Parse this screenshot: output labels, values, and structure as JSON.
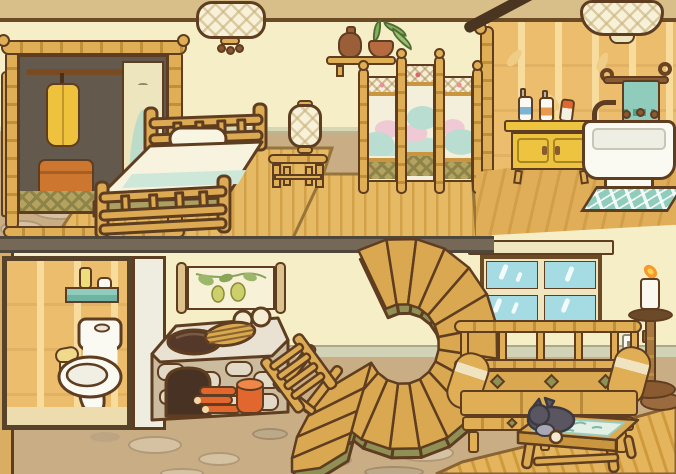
{
  "scene": {
    "title": "Two-story bamboo house interior",
    "style": "hand-drawn cozy home decoration game, cutaway view",
    "visible_text": "none"
  },
  "palette": {
    "outline": "#5f3d20",
    "wall_cream": "#f5eec6",
    "ceiling_tan": "#d8be88",
    "bamboo": "#dfae55",
    "bamboo_shade": "#c08f3a",
    "bathroom_wall": "#ecbd6d",
    "floor_tan": "#c9ae85",
    "stone": "#d5c2a2",
    "mat_gold": "#e6ba64",
    "teal": "#8fccbc",
    "glass_blue": "#a5dce4",
    "mint": "#cde8d9",
    "olive": "#8f9055",
    "step_gold": "#d9a850",
    "orange": "#e2672f",
    "cabinet_yellow": "#eec33f",
    "divider_grey": "#756857",
    "baseboard_sage": "#d2d2b6",
    "white": "#fbfaf2"
  },
  "upper_floor": {
    "bedroom": {
      "items": [
        {
          "name": "hanging lattice lantern"
        },
        {
          "name": "bamboo wardrobe with open door, yellow robe and orange suitcase"
        },
        {
          "name": "bamboo double bed with mint bedding and pillow"
        },
        {
          "name": "bedside bamboo stool with lattice lamp"
        },
        {
          "name": "wall shelf with brown vase and potted plant"
        },
        {
          "name": "three-panel bamboo folding screen with landscape painting"
        },
        {
          "name": "round window"
        },
        {
          "name": "woven tatami floor mats"
        }
      ]
    },
    "bathroom": {
      "items": [
        {
          "name": "ceiling lattice lamp"
        },
        {
          "name": "towel rack with teal towel"
        },
        {
          "name": "yellow vanity cabinet"
        },
        {
          "name": "toiletry bottles and tube"
        },
        {
          "name": "white washbasin tub with faucet"
        },
        {
          "name": "teal bath mat"
        },
        {
          "name": "wooden plank floor"
        },
        {
          "name": "sloped roof beam"
        }
      ]
    }
  },
  "lower_floor": {
    "items": [
      {
        "name": "toilet alcove with bamboo wallpaper"
      },
      {
        "name": "white toilet"
      },
      {
        "name": "teal wall shelf with toiletries"
      },
      {
        "name": "toilet paper roll"
      },
      {
        "name": "hanging scroll painting with leaves and gourds"
      },
      {
        "name": "stone cooking stove"
      },
      {
        "name": "dark pot and woven lid"
      },
      {
        "name": "steamed buns"
      },
      {
        "name": "stacked firewood"
      },
      {
        "name": "orange pail"
      },
      {
        "name": "bamboo folding chair"
      },
      {
        "name": "spiral staircase"
      },
      {
        "name": "window with teal panes"
      },
      {
        "name": "bamboo sofa with bolster cushions"
      },
      {
        "name": "bamboo coffee table"
      },
      {
        "name": "sleeping grey cat"
      },
      {
        "name": "tall candle stand with lit candle"
      },
      {
        "name": "wall outlet"
      },
      {
        "name": "wall plug"
      },
      {
        "name": "woven floor mat"
      },
      {
        "name": "brown floor cushion"
      }
    ]
  }
}
